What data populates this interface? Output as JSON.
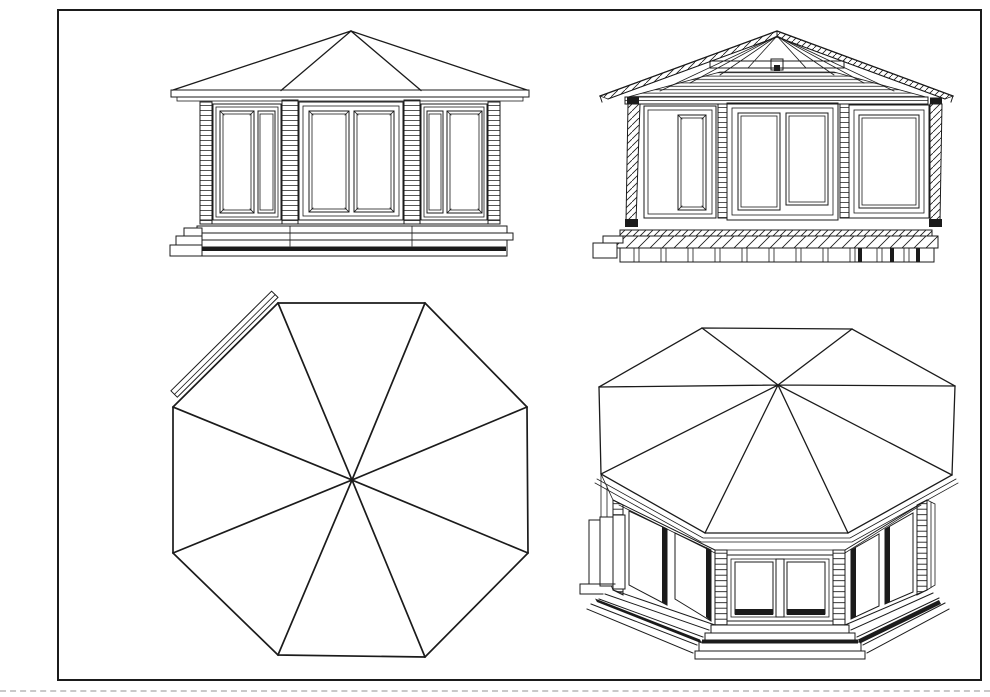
{
  "page": {
    "background_color": "#ffffff",
    "line_color": "#1b1b1b",
    "frame_color": "#1b1b1b",
    "divider_color": "#c9c9c9"
  },
  "sheet": {
    "subject": "octagonal-gazebo-technical-drawing",
    "views": [
      {
        "id": "front-elevation",
        "position": "top-left"
      },
      {
        "id": "section-elevation",
        "position": "top-right"
      },
      {
        "id": "roof-plan",
        "position": "bottom-left"
      },
      {
        "id": "perspective-view",
        "position": "bottom-right"
      }
    ]
  }
}
